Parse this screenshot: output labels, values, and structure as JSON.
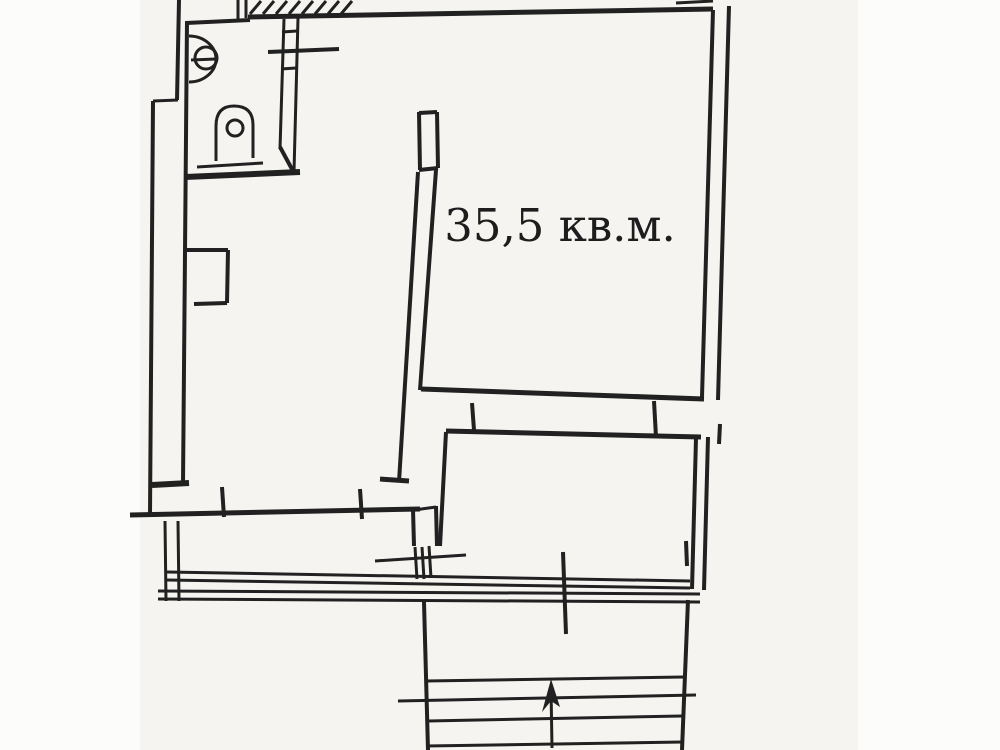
{
  "document": {
    "type": "scanned apartment floor plan (BTI style technical drawing)",
    "language": "Russian"
  },
  "canvas": {
    "width": 1000,
    "height": 750,
    "page_bg": "#fcfcfb",
    "scan_bg": "#f5f4f1",
    "scan_left": 140,
    "scan_width": 718,
    "ink": "#212121"
  },
  "floorplan": {
    "area_label": {
      "text": "35,5 кв.м.",
      "x": 560,
      "y": 241,
      "font_size": 45
    },
    "hatch": {
      "name": "stair-hatch",
      "x_start": 250,
      "count": 8,
      "step": 13,
      "dx": 11,
      "y_top": 1,
      "y_bottom": 14,
      "w": 3
    },
    "lines": [
      {
        "name": "top-wall-left",
        "x1": 186,
        "y1": 23,
        "x2": 250,
        "y2": 20,
        "w": 4
      },
      {
        "name": "top-wall-main",
        "x1": 248,
        "y1": 17,
        "x2": 713,
        "y2": 9,
        "w": 5
      },
      {
        "name": "top-notch-left",
        "x1": 238,
        "y1": 0,
        "x2": 238,
        "y2": 19,
        "w": 3
      },
      {
        "name": "top-notch-right",
        "x1": 246,
        "y1": 0,
        "x2": 246,
        "y2": 18,
        "w": 3
      },
      {
        "name": "top-right-stub",
        "x1": 676,
        "y1": 3,
        "x2": 713,
        "y2": 1,
        "w": 3
      },
      {
        "name": "right-wall-inner",
        "x1": 713,
        "y1": 10,
        "x2": 702,
        "y2": 397,
        "w": 4
      },
      {
        "name": "right-wall-outer",
        "x1": 729,
        "y1": 6,
        "x2": 718,
        "y2": 400,
        "w": 4
      },
      {
        "name": "right-outer-fragment",
        "x1": 720,
        "y1": 424,
        "x2": 719,
        "y2": 444,
        "w": 4
      },
      {
        "name": "left-wall-inner",
        "x1": 187,
        "y1": 21,
        "x2": 183,
        "y2": 484,
        "w": 4
      },
      {
        "name": "left-wall-outer-top",
        "x1": 179,
        "y1": 0,
        "x2": 177,
        "y2": 100,
        "w": 4
      },
      {
        "name": "left-wall-jog",
        "x1": 153,
        "y1": 101,
        "x2": 178,
        "y2": 100,
        "w": 3
      },
      {
        "name": "left-wall-outer",
        "x1": 153,
        "y1": 101,
        "x2": 150,
        "y2": 514,
        "w": 4
      },
      {
        "name": "bathroom-bottom-wall",
        "x1": 185,
        "y1": 177,
        "x2": 300,
        "y2": 172,
        "w": 6
      },
      {
        "name": "toilet-base-line",
        "x1": 197,
        "y1": 167,
        "x2": 263,
        "y2": 163,
        "w": 3
      },
      {
        "name": "bathroom-right-wall-a",
        "x1": 284,
        "y1": 19,
        "x2": 280,
        "y2": 149,
        "w": 3
      },
      {
        "name": "bathroom-right-wall-b",
        "x1": 298,
        "y1": 18,
        "x2": 294,
        "y2": 172,
        "w": 3
      },
      {
        "name": "bathroom-wall-rung-1",
        "x1": 282,
        "y1": 32,
        "x2": 297,
        "y2": 31,
        "w": 3
      },
      {
        "name": "bathroom-wall-rung-2",
        "x1": 281,
        "y1": 69,
        "x2": 296,
        "y2": 68,
        "w": 3
      },
      {
        "name": "bathroom-shelf-line",
        "x1": 268,
        "y1": 52,
        "x2": 339,
        "y2": 49,
        "w": 4
      },
      {
        "name": "bathroom-door-leaf",
        "x1": 280,
        "y1": 147,
        "x2": 293,
        "y2": 171,
        "w": 4
      },
      {
        "name": "sink-bar",
        "x1": 191,
        "y1": 60,
        "x2": 216,
        "y2": 59,
        "w": 3
      },
      {
        "name": "middle-wall-cap-left",
        "x1": 419,
        "y1": 112,
        "x2": 420,
        "y2": 170,
        "w": 4
      },
      {
        "name": "middle-wall-cap-right",
        "x1": 437,
        "y1": 112,
        "x2": 438,
        "y2": 168,
        "w": 4
      },
      {
        "name": "middle-wall-cap-top",
        "x1": 419,
        "y1": 113,
        "x2": 437,
        "y2": 112,
        "w": 4
      },
      {
        "name": "middle-wall-cap-divider",
        "x1": 419,
        "y1": 170,
        "x2": 438,
        "y2": 168,
        "w": 4
      },
      {
        "name": "middle-wall-left",
        "x1": 418,
        "y1": 172,
        "x2": 399,
        "y2": 482,
        "w": 4
      },
      {
        "name": "middle-wall-right",
        "x1": 436,
        "y1": 170,
        "x2": 420,
        "y2": 390,
        "w": 4
      },
      {
        "name": "big-room-bottom-wall",
        "x1": 421,
        "y1": 389,
        "x2": 704,
        "y2": 399,
        "w": 5
      },
      {
        "name": "small-room-top-wall",
        "x1": 446,
        "y1": 431,
        "x2": 701,
        "y2": 437,
        "w": 5
      },
      {
        "name": "opening-jamb-tick-1",
        "x1": 472,
        "y1": 403,
        "x2": 474,
        "y2": 430,
        "w": 4
      },
      {
        "name": "opening-jamb-tick-2",
        "x1": 654,
        "y1": 401,
        "x2": 656,
        "y2": 437,
        "w": 4
      },
      {
        "name": "left-room-bottom-stub-right",
        "x1": 380,
        "y1": 479,
        "x2": 409,
        "y2": 481,
        "w": 5
      },
      {
        "name": "left-room-corner-stub",
        "x1": 152,
        "y1": 485,
        "x2": 189,
        "y2": 483,
        "w": 6
      },
      {
        "name": "corridor-top-wall",
        "x1": 130,
        "y1": 515,
        "x2": 420,
        "y2": 509,
        "w": 5
      },
      {
        "name": "corridor-jamb-tick-1",
        "x1": 222,
        "y1": 487,
        "x2": 224,
        "y2": 517,
        "w": 4
      },
      {
        "name": "corridor-jamb-tick-2",
        "x1": 360,
        "y1": 489,
        "x2": 362,
        "y2": 519,
        "w": 4
      },
      {
        "name": "window-jamb-left",
        "x1": 413,
        "y1": 509,
        "x2": 414,
        "y2": 546,
        "w": 4
      },
      {
        "name": "window-jamb-right",
        "x1": 436,
        "y1": 506,
        "x2": 437,
        "y2": 546,
        "w": 4
      },
      {
        "name": "window-jamb-top",
        "x1": 414,
        "y1": 510,
        "x2": 436,
        "y2": 507,
        "w": 3
      },
      {
        "name": "window-sill-line",
        "x1": 375,
        "y1": 561,
        "x2": 466,
        "y2": 555,
        "w": 3
      },
      {
        "name": "window-hatch-1",
        "x1": 415,
        "y1": 547,
        "x2": 417,
        "y2": 579,
        "w": 3
      },
      {
        "name": "window-hatch-2",
        "x1": 422,
        "y1": 547,
        "x2": 424,
        "y2": 579,
        "w": 3
      },
      {
        "name": "window-hatch-3",
        "x1": 429,
        "y1": 546,
        "x2": 431,
        "y2": 578,
        "w": 3
      },
      {
        "name": "balcony-left-wall-a",
        "x1": 165,
        "y1": 521,
        "x2": 166,
        "y2": 601,
        "w": 3
      },
      {
        "name": "balcony-left-wall-b",
        "x1": 178,
        "y1": 521,
        "x2": 179,
        "y2": 601,
        "w": 3
      },
      {
        "name": "balcony-front-wall-a1",
        "x1": 167,
        "y1": 572,
        "x2": 690,
        "y2": 581,
        "w": 3
      },
      {
        "name": "balcony-front-wall-a2",
        "x1": 167,
        "y1": 580,
        "x2": 690,
        "y2": 588,
        "w": 3
      },
      {
        "name": "balcony-front-wall-b1",
        "x1": 158,
        "y1": 591,
        "x2": 700,
        "y2": 594,
        "w": 3
      },
      {
        "name": "balcony-front-wall-b2",
        "x1": 158,
        "y1": 599,
        "x2": 700,
        "y2": 602,
        "w": 3
      },
      {
        "name": "balcony-mid-tick",
        "x1": 563,
        "y1": 552,
        "x2": 566,
        "y2": 634,
        "w": 4
      },
      {
        "name": "balcony-right-tick",
        "x1": 686,
        "y1": 541,
        "x2": 687,
        "y2": 566,
        "w": 4
      },
      {
        "name": "small-room-left-wall",
        "x1": 446,
        "y1": 432,
        "x2": 440,
        "y2": 546,
        "w": 4
      },
      {
        "name": "small-room-right-wall-inner",
        "x1": 696,
        "y1": 438,
        "x2": 692,
        "y2": 589,
        "w": 4
      },
      {
        "name": "small-room-right-wall-outer",
        "x1": 708,
        "y1": 437,
        "x2": 704,
        "y2": 590,
        "w": 4
      },
      {
        "name": "stair-left-wall",
        "x1": 424,
        "y1": 602,
        "x2": 428,
        "y2": 750,
        "w": 4
      },
      {
        "name": "stair-right-wall",
        "x1": 688,
        "y1": 600,
        "x2": 682,
        "y2": 750,
        "w": 4
      },
      {
        "name": "stair-tread-1",
        "x1": 426,
        "y1": 681,
        "x2": 684,
        "y2": 677,
        "w": 3
      },
      {
        "name": "stair-tread-2",
        "x1": 398,
        "y1": 701,
        "x2": 696,
        "y2": 695,
        "w": 3
      },
      {
        "name": "stair-tread-3",
        "x1": 428,
        "y1": 721,
        "x2": 682,
        "y2": 716,
        "w": 3
      },
      {
        "name": "stair-tread-4",
        "x1": 426,
        "y1": 746,
        "x2": 683,
        "y2": 742,
        "w": 3
      },
      {
        "name": "stair-arrow-shaft",
        "x1": 552,
        "y1": 748,
        "x2": 551,
        "y2": 688,
        "w": 3
      },
      {
        "name": "radiator-top",
        "x1": 186,
        "y1": 250,
        "x2": 228,
        "y2": 250,
        "w": 4
      },
      {
        "name": "radiator-right",
        "x1": 228,
        "y1": 250,
        "x2": 227,
        "y2": 303,
        "w": 4
      },
      {
        "name": "radiator-bottom",
        "x1": 194,
        "y1": 304,
        "x2": 227,
        "y2": 303,
        "w": 4
      }
    ],
    "circles": [
      {
        "name": "toilet-flush-circle",
        "cx": 235,
        "cy": 128,
        "r": 8,
        "w": 3
      },
      {
        "name": "sink-inner-circle",
        "cx": 206,
        "cy": 58,
        "r": 11,
        "w": 3
      }
    ],
    "paths": [
      {
        "name": "sink-outline",
        "d": "M 189,36 A 27 23 0 0 1 189,82",
        "w": 3
      },
      {
        "name": "toilet-outline",
        "d": "M 216,161 L 216,126 Q 216,106 234,106 Q 253,106 253,125 L 253,158",
        "w": 3
      }
    ],
    "polygons": [
      {
        "name": "stair-arrow-head",
        "points": "551,679 542,712 551,701 560,707"
      }
    ]
  }
}
